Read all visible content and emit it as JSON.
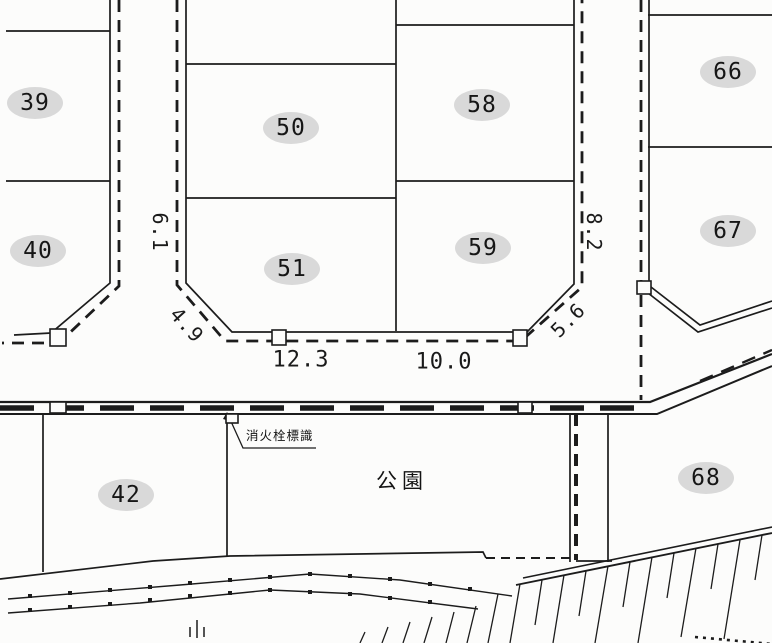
{
  "colors": {
    "ink": "#1c1c1c",
    "paper": "#fcfcfb",
    "lot_label_background": "#d9d9d9"
  },
  "lots": [
    {
      "number": "39"
    },
    {
      "number": "40"
    },
    {
      "number": "42"
    },
    {
      "number": "50"
    },
    {
      "number": "51"
    },
    {
      "number": "58"
    },
    {
      "number": "59"
    },
    {
      "number": "66"
    },
    {
      "number": "67"
    },
    {
      "number": "68"
    }
  ],
  "measurements": [
    {
      "value": "6.1"
    },
    {
      "value": "4.9"
    },
    {
      "value": "12.3"
    },
    {
      "value": "10.0"
    },
    {
      "value": "5.6"
    },
    {
      "value": "8.2"
    }
  ],
  "annotations": {
    "park": "公園",
    "hydrant_sign": "消火栓標識"
  }
}
